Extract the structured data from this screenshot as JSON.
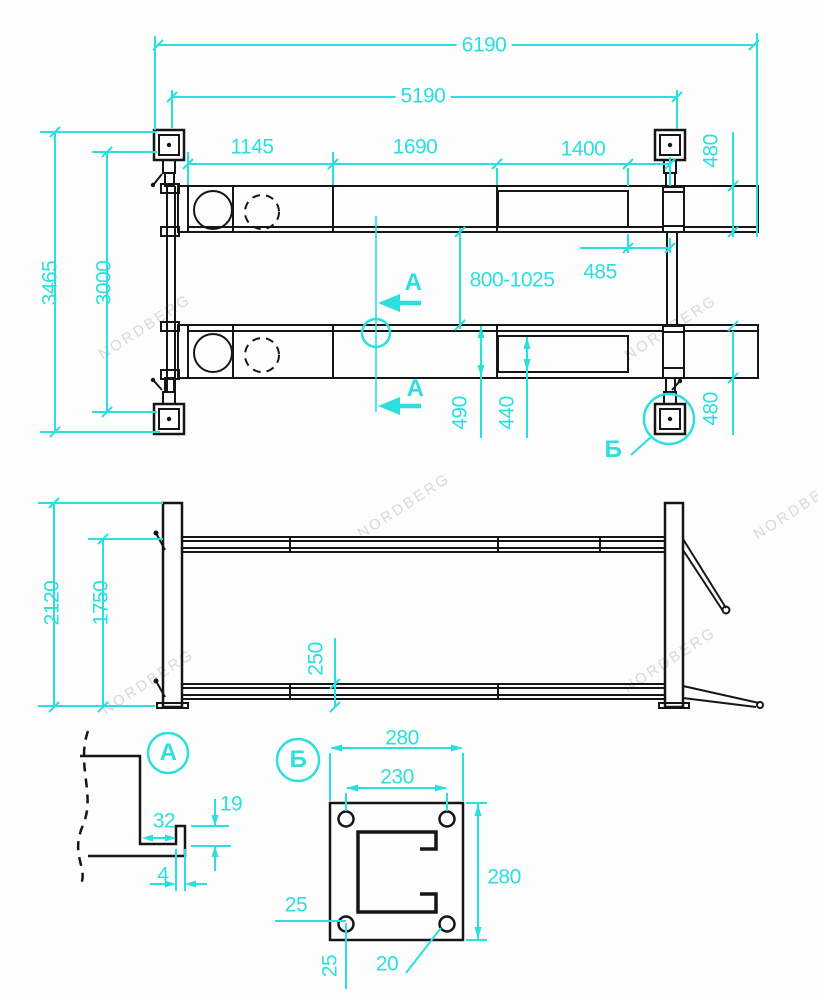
{
  "colors": {
    "accent": "#2bdfdf",
    "line": "#161616",
    "watermark": "#d9d9d9",
    "background": "#fdfdfd"
  },
  "watermark_text": "NORDBERG",
  "top_view": {
    "labels": {
      "overall_length": "6190",
      "post_span": "5190",
      "seg_left": "1145",
      "seg_mid": "1690",
      "seg_right": "1400",
      "runway_width_top": "480",
      "runway_width_bottom": "480",
      "overall_width": "3465",
      "post_width": "3000",
      "track_range": "800-1025",
      "offset": "485",
      "runway_width_dim": "490",
      "platform_inner": "440",
      "section_mark_top": "A",
      "section_mark_bottom": "A",
      "detail_mark": "Б"
    }
  },
  "side_view": {
    "labels": {
      "column_height": "2120",
      "rail_height": "1750",
      "min_height": "250"
    }
  },
  "detail_a": {
    "title": "A",
    "labels": {
      "width": "32",
      "lip_height": "19",
      "thickness": "4"
    }
  },
  "detail_b": {
    "title": "Б",
    "labels": {
      "plate_width": "280",
      "hole_spacing": "230",
      "plate_height": "280",
      "edge_offset_left": "25",
      "edge_offset_bottom": "25",
      "hole_diameter": "20"
    }
  }
}
